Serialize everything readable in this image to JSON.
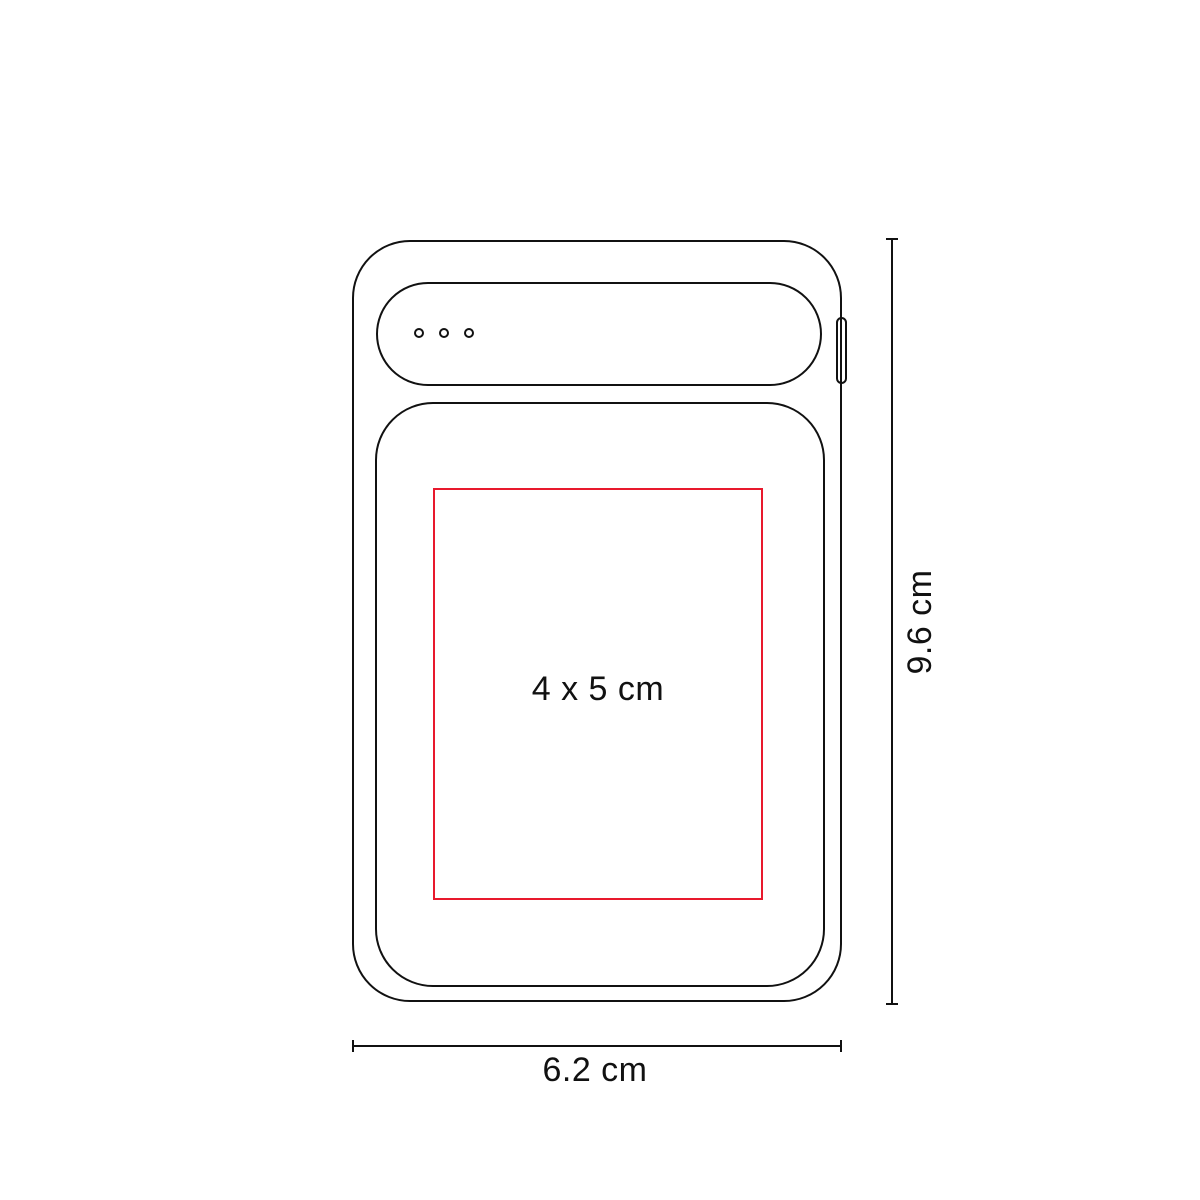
{
  "diagram": {
    "labels": {
      "print_area": "4 x 5 cm",
      "width": "6.2 cm",
      "height": "9.6 cm"
    },
    "device": {
      "led_dots_count": 3
    },
    "colors": {
      "outline": "#111111",
      "print_area_red": "#e8192d",
      "background": "#ffffff",
      "text": "#111111"
    }
  }
}
